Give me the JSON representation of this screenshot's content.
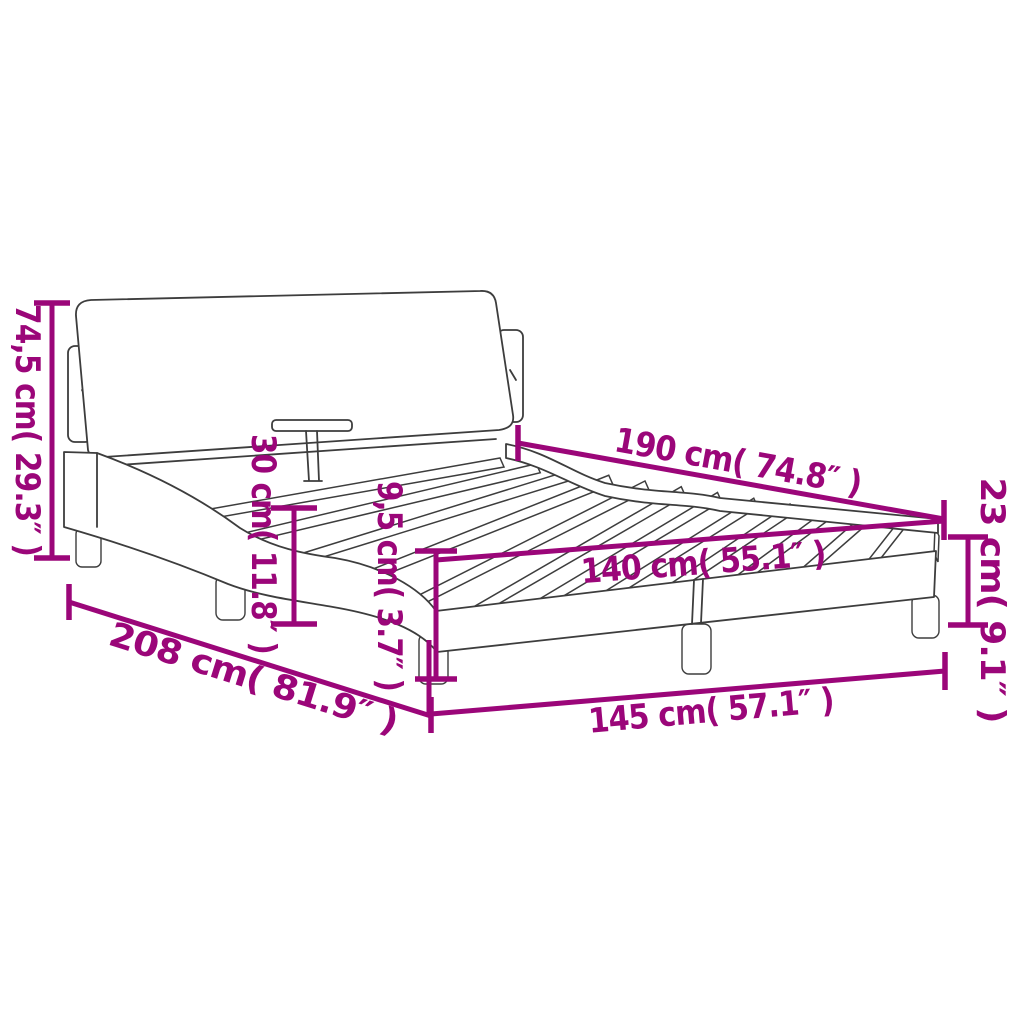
{
  "diagram": {
    "title": "bed-frame-with-headboard-dimension-diagram",
    "colors": {
      "accent": "#9B0679",
      "line": "#3D3D3D",
      "background": "#FFFFFF"
    },
    "dimensions": [
      {
        "name": "headboard-total-height",
        "label": "74,5 cm( 29.3″ )",
        "value_cm": "74,5",
        "value_inch": "29.3"
      },
      {
        "name": "headboard-above-frame-height",
        "label": "30 cm( 11.8″ )",
        "value_cm": "30",
        "value_inch": "11.8"
      },
      {
        "name": "rail-thickness",
        "label": "9,5 cm( 3.7″ )",
        "value_cm": "9,5",
        "value_inch": "3.7"
      },
      {
        "name": "mattress-length",
        "label": "190 cm( 74.8″ )",
        "value_cm": "190",
        "value_inch": "74.8"
      },
      {
        "name": "mattress-width",
        "label": "140 cm( 55.1″ )",
        "value_cm": "140",
        "value_inch": "55.1"
      },
      {
        "name": "frame-side-height",
        "label": "23 cm( 9.1″ )",
        "value_cm": "23",
        "value_inch": "9.1"
      },
      {
        "name": "frame-outer-width",
        "label": "145 cm( 57.1″ )",
        "value_cm": "145",
        "value_inch": "57.1"
      },
      {
        "name": "frame-outer-length",
        "label": "208 cm( 81.9″ )",
        "value_cm": "208",
        "value_inch": "81.9"
      }
    ]
  }
}
